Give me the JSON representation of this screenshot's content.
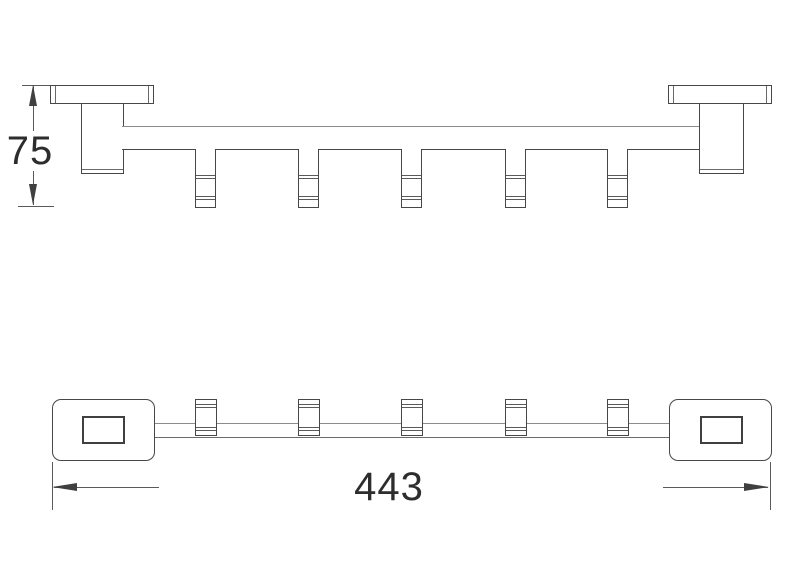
{
  "drawing": {
    "kind": "technical-drawing",
    "subject": "towel-bar-with-hooks",
    "hook_count": 5,
    "colors": {
      "background": "#ffffff",
      "line": "#474747",
      "dimension_line": "#5a5a5a",
      "text": "#2d2d2d"
    },
    "dimensions": {
      "height": {
        "label": "75"
      },
      "width": {
        "label": "443"
      }
    }
  }
}
